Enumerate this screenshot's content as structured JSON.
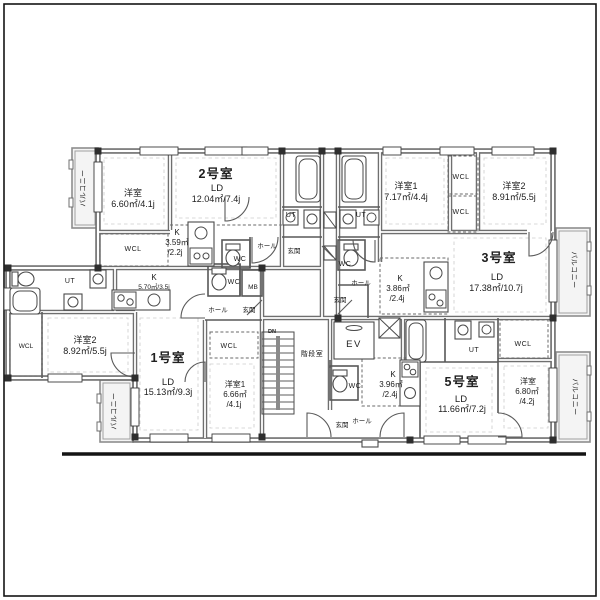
{
  "units": {
    "unit1": {
      "name": "1号室",
      "ld": "LD",
      "ld_area": "15.13㎡/9.3j",
      "k": "K",
      "k_area": "5.70㎡/3.5j",
      "bed1": "洋室1",
      "bed1_area": "6.66㎡",
      "bed1_area2": "/4.1j",
      "bed2": "洋室2",
      "bed2_area": "8.92㎡/5.5j"
    },
    "unit2": {
      "name": "2号室",
      "ld": "LD",
      "ld_area": "12.04㎡/7.4j",
      "k": "K",
      "k_area": "3.59㎡",
      "k_area2": "/2.2j",
      "bed": "洋室",
      "bed_area": "6.60㎡/4.1j"
    },
    "unit3": {
      "name": "3号室",
      "ld": "LD",
      "ld_area": "17.38㎡/10.7j",
      "k": "K",
      "k_area": "3.86㎡",
      "k_area2": "/2.4j",
      "bed1": "洋室1",
      "bed1_area": "7.17㎡/4.4j",
      "bed2": "洋室2",
      "bed2_area": "8.91㎡/5.5j"
    },
    "unit5": {
      "name": "5号室",
      "ld": "LD",
      "ld_area": "11.66㎡/7.2j",
      "k": "K",
      "k_area": "3.96㎡",
      "k_area2": "/2.4j",
      "bed": "洋室",
      "bed_area": "6.80㎡",
      "bed_area2": "/4.2j"
    }
  },
  "labels": {
    "wcl": "WCL",
    "ut": "UT",
    "wc": "WC",
    "mb": "MB",
    "hall": "ホール",
    "entrance": "玄関",
    "balcony": "バルコニー",
    "stair_room": "階段室",
    "elevator": "EV",
    "down": "DN"
  }
}
